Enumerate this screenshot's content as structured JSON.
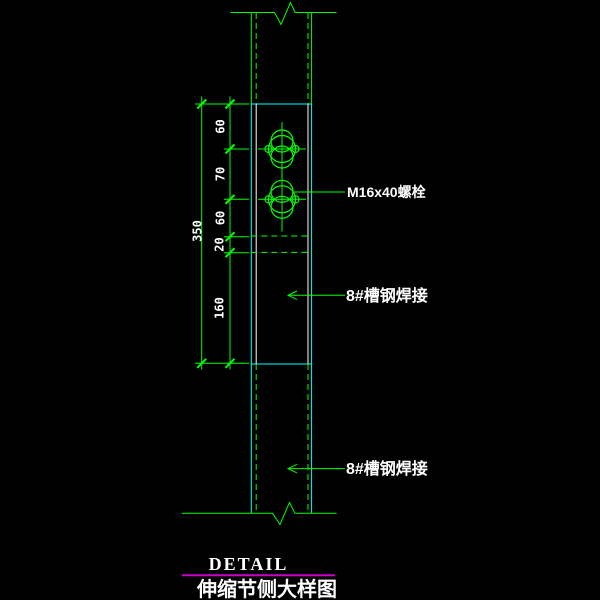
{
  "colors": {
    "background": "#000000",
    "line_green": "#00ff00",
    "line_cyan": "#00ffff",
    "text_white": "#ffffff",
    "title_rule_magenta": "#cc00cc"
  },
  "dimensions": {
    "segments": [
      "60",
      "70",
      "60",
      "20",
      "160"
    ],
    "overall": "350"
  },
  "labels": {
    "bolt": "M16x40螺栓",
    "weld_upper": "8#槽钢焊接",
    "weld_lower": "8#槽钢焊接"
  },
  "title_block": {
    "detail": "DETAIL",
    "drawing_title": "伸缩节侧大样图"
  }
}
